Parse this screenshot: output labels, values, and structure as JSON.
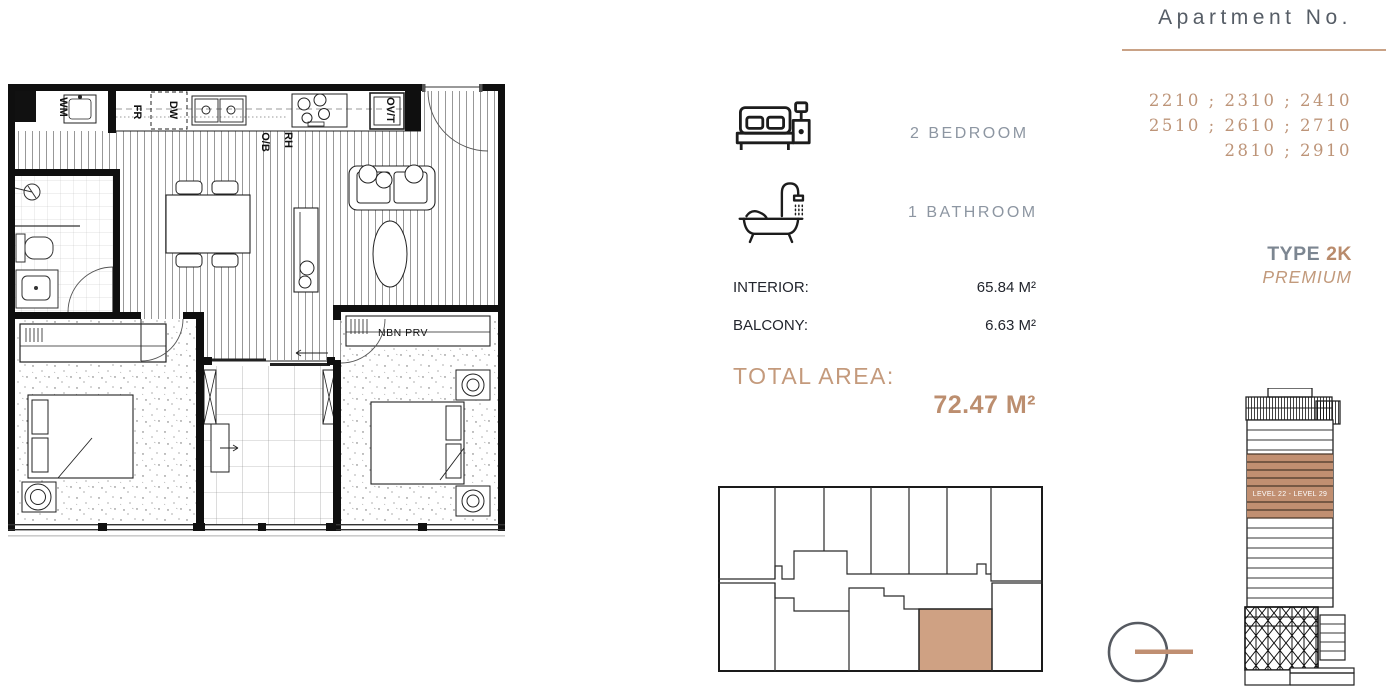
{
  "colors": {
    "accent_text": "#bd9478",
    "accent_bold": "#bc8e6f",
    "highlight_fill": "#cfa183",
    "tower_band_fill": "#c18f71",
    "gray_label": "#8d96a2",
    "title_gray": "#565d66",
    "dark_text": "#22252d",
    "divider_tan": "#c9a286"
  },
  "header": {
    "title": "Apartment No.",
    "numbers_line1": "2210 ; 2310 ; 2410",
    "numbers_line2": "2510 ; 2610 ; 2710",
    "numbers_line3": "2810 ; 2910"
  },
  "type": {
    "label": "TYPE ",
    "value": "2K",
    "tier": "PREMIUM"
  },
  "features": {
    "bedroom": {
      "icon": "bed-icon",
      "label": "2 BEDROOM"
    },
    "bathroom": {
      "icon": "bath-icon",
      "label": "1 BATHROOM"
    }
  },
  "areas": {
    "interior_label": "INTERIOR:",
    "interior_value": "65.84 M²",
    "balcony_label": "BALCONY:",
    "balcony_value": "6.63 M²",
    "total_label": "TOTAL AREA:",
    "total_value": "72.47 M²"
  },
  "floor_plan": {
    "labels": {
      "wm": "WM",
      "fr": "FR",
      "dw": "DW",
      "ovt": "OV/T",
      "ob": "O/B",
      "rh": "RH",
      "nbn": "NBN PRV"
    }
  },
  "tower": {
    "level_range": "LEVEL 22 - LEVEL 29"
  }
}
